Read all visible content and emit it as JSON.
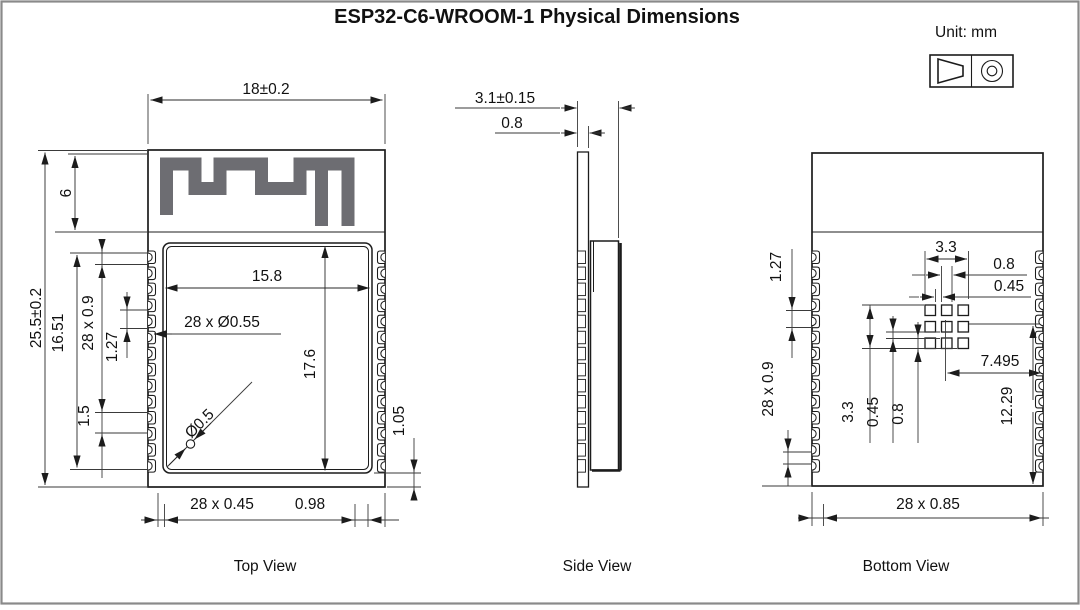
{
  "header": {
    "title": "ESP32-C6-WROOM-1 Physical Dimensions",
    "unit": "Unit: mm"
  },
  "colors": {
    "line": "#1c1c1c",
    "antenna_trace": "#6d6d72",
    "page_border": "#8a8a8a"
  },
  "top_view": {
    "label": "Top View",
    "module_width": "18±0.2",
    "antenna_height": "6",
    "module_height": "25.5±0.2",
    "pad_row_span": "16.51",
    "pad_length": "28 x 0.9",
    "pad_pitch": "1.27",
    "pad_offset": "1.5",
    "shield_width": "15.8",
    "castellation_holes": "28 x Ø0.55",
    "via_diameter": "Ø0.5",
    "shield_height": "17.6",
    "shield_bottom_gap": "1.05",
    "pad_width": "28 x 0.45",
    "corner_gap": "0.98"
  },
  "side_view": {
    "label": "Side View",
    "total_thickness": "3.1±0.15",
    "pcb_thickness": "0.8"
  },
  "bottom_view": {
    "label": "Bottom View",
    "thermal_grid_width": "3.3",
    "pad_col_width": "0.8",
    "pad_col_gap": "0.45",
    "edge_pad_pitch": "1.27",
    "edge_pad_length": "28 x 0.9",
    "thermal_grid_height": "3.3",
    "pad_row_gap": "0.45",
    "pad_row_height": "0.8",
    "grid_center_to_edge": "7.495",
    "grid_to_bottom_edge": "12.29",
    "pad_width": "28 x 0.85"
  }
}
